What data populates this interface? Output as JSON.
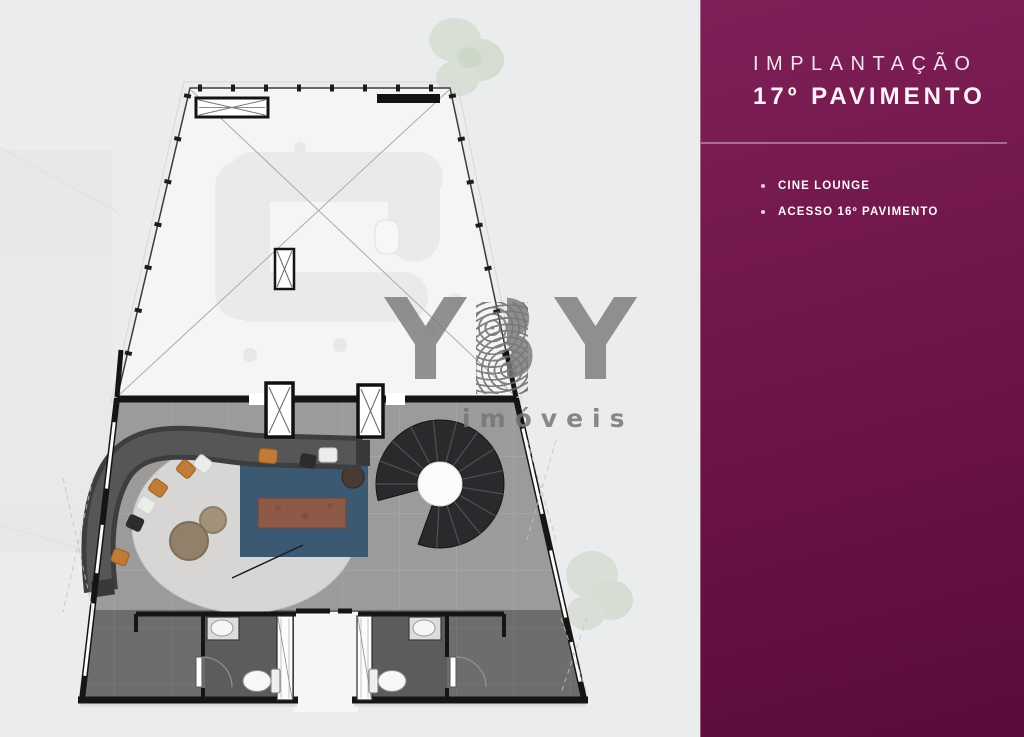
{
  "panel": {
    "title_line1": "IMPLANTAÇÃO",
    "title_line2": "17º PAVIMENTO",
    "bullets": [
      {
        "label": "CINE LOUNGE"
      },
      {
        "label": "ACESSO 16º PAVIMENTO"
      }
    ]
  },
  "watermark": {
    "letters": [
      "Y",
      "B",
      "Y"
    ],
    "tagline": "imóveis"
  },
  "colors": {
    "panel_background": "#6d1347",
    "panel_text": "#f7edf3",
    "page_background": "#ebecee",
    "terrace_floor": "#f5f5f6",
    "lounge_floor": "#9c9b99",
    "service_floor": "#6e6d6b",
    "bathroom_floor": "#5d5c5a",
    "wall": "#151515",
    "rug_circle": "#d7d6d4",
    "rug_blue": "#3b5972",
    "media_table": "#8d5a48",
    "sofa": "#4e4e50",
    "stair": "#2a2a2c",
    "watermark_gray": "#7a7a7a",
    "greenery": "#cfdac8"
  }
}
